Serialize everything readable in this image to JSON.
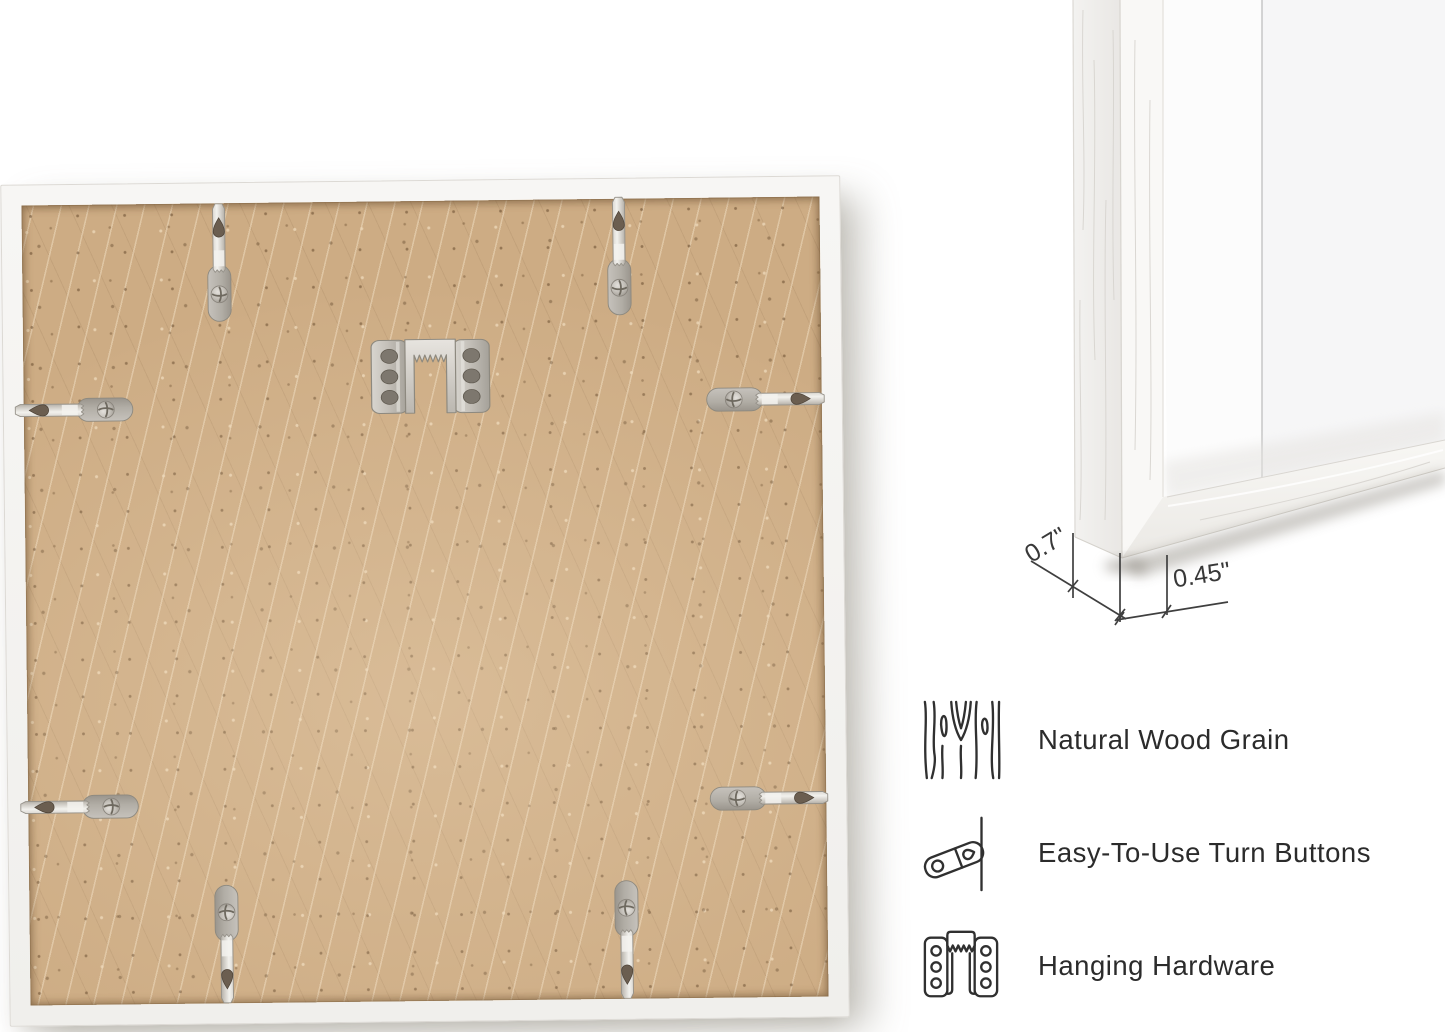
{
  "dimensions": {
    "depth": "0.7\"",
    "face_width": "0.45\""
  },
  "features": [
    {
      "icon": "wood-grain-icon",
      "label": "Natural Wood Grain"
    },
    {
      "icon": "turn-button-icon",
      "label": "Easy-To-Use Turn Buttons"
    },
    {
      "icon": "hanging-hardware-icon",
      "label": "Hanging Hardware"
    }
  ],
  "colors": {
    "backing_board": "#cdac84",
    "frame_white": "#f4f3f1",
    "metal_hardware": "#bdb9b2",
    "annotation_line": "#3f3f3f",
    "label_text": "#2b2b2b"
  }
}
